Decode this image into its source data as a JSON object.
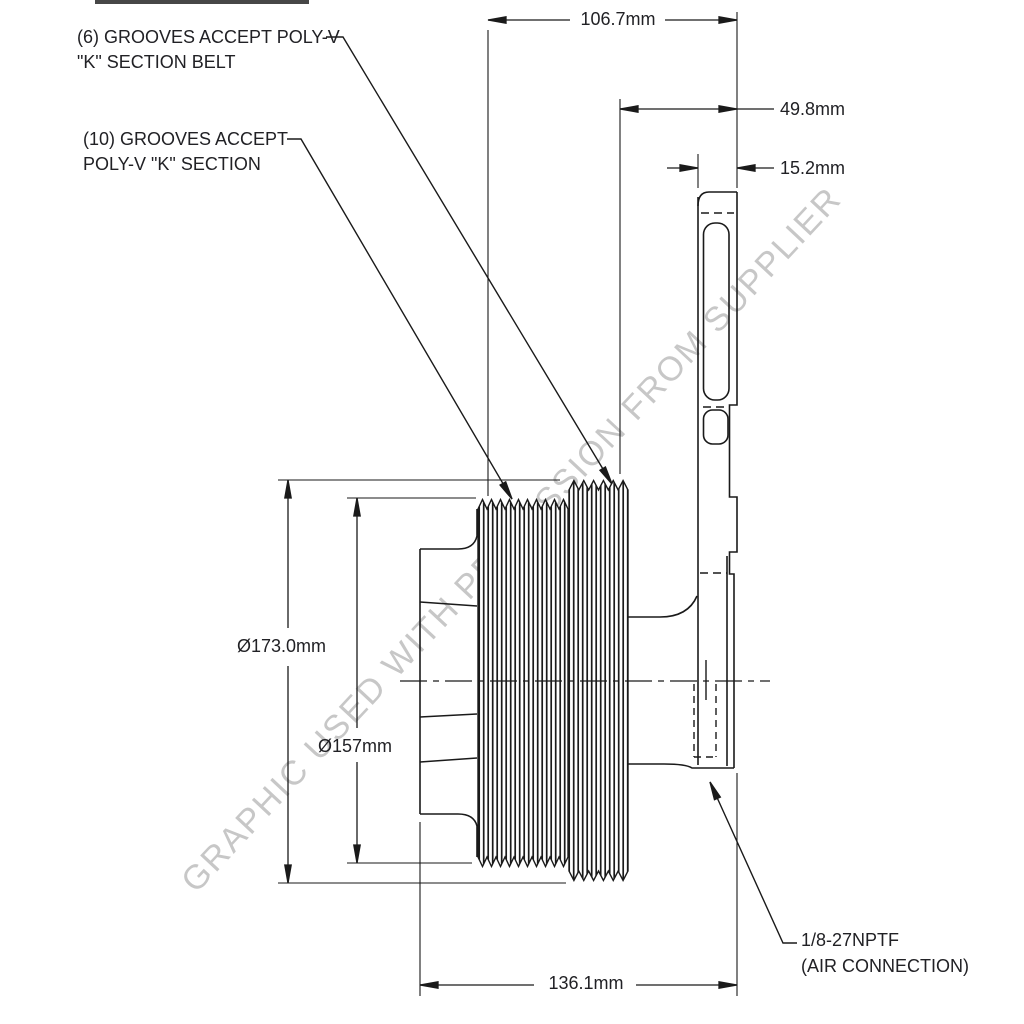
{
  "watermark": "GRAPHIC USED WITH PERMISSION FROM SUPPLIER",
  "annotations": {
    "grooves_6": {
      "line1": "(6) GROOVES ACCEPT POLY-V",
      "line2": "\"K\" SECTION BELT"
    },
    "grooves_10": {
      "line1": "(10) GROOVES ACCEPT",
      "line2": "POLY-V \"K\" SECTION"
    },
    "air_connection": {
      "line1": "1/8-27NPTF",
      "line2": "(AIR CONNECTION)"
    }
  },
  "dimensions": {
    "overall_width": "106.7mm",
    "flange_offset": "49.8mm",
    "flange_thickness": "15.2mm",
    "outer_diameter": "Ø173.0mm",
    "inner_diameter": "Ø157mm",
    "body_length": "136.1mm"
  },
  "colors": {
    "line": "#1a1a1a",
    "watermark": "#c7c7c7",
    "background": "#ffffff"
  }
}
